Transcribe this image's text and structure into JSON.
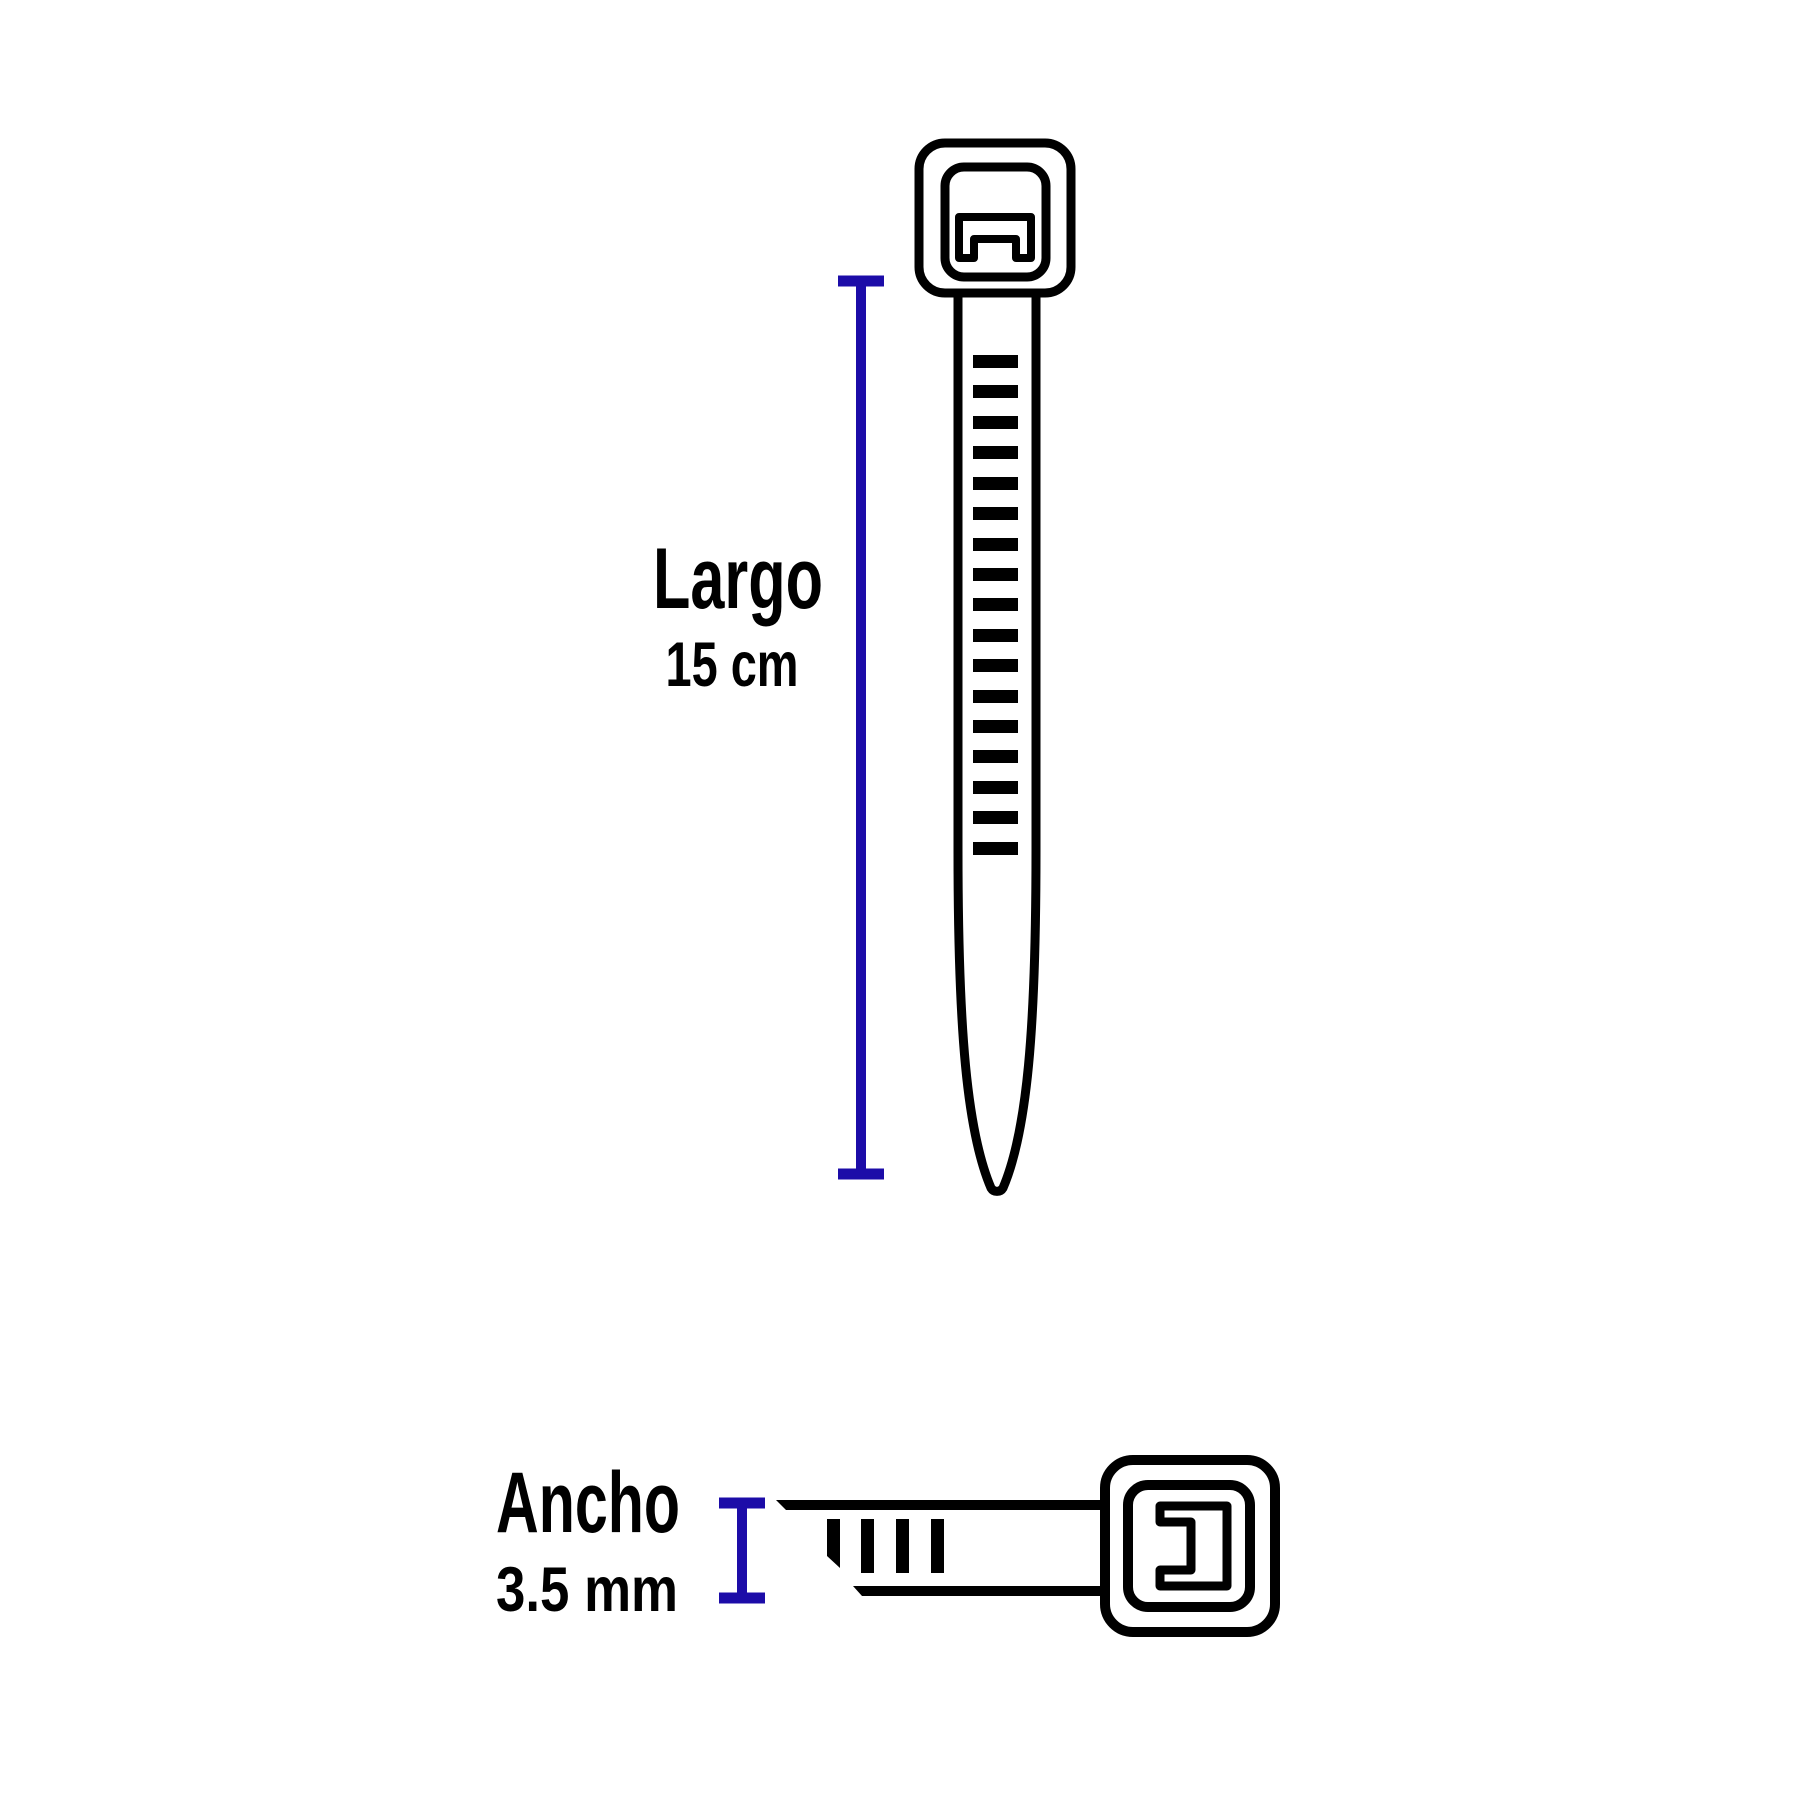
{
  "diagram": {
    "subject": "cable-tie-dimensions",
    "background_color": "#ffffff",
    "outline_color": "#000000",
    "dimension_line_color": "#1C0CA8",
    "label_color": "#000000",
    "length": {
      "label": "Largo",
      "value": "15 cm"
    },
    "width": {
      "label": "Ancho",
      "value": "3.5 mm"
    }
  }
}
